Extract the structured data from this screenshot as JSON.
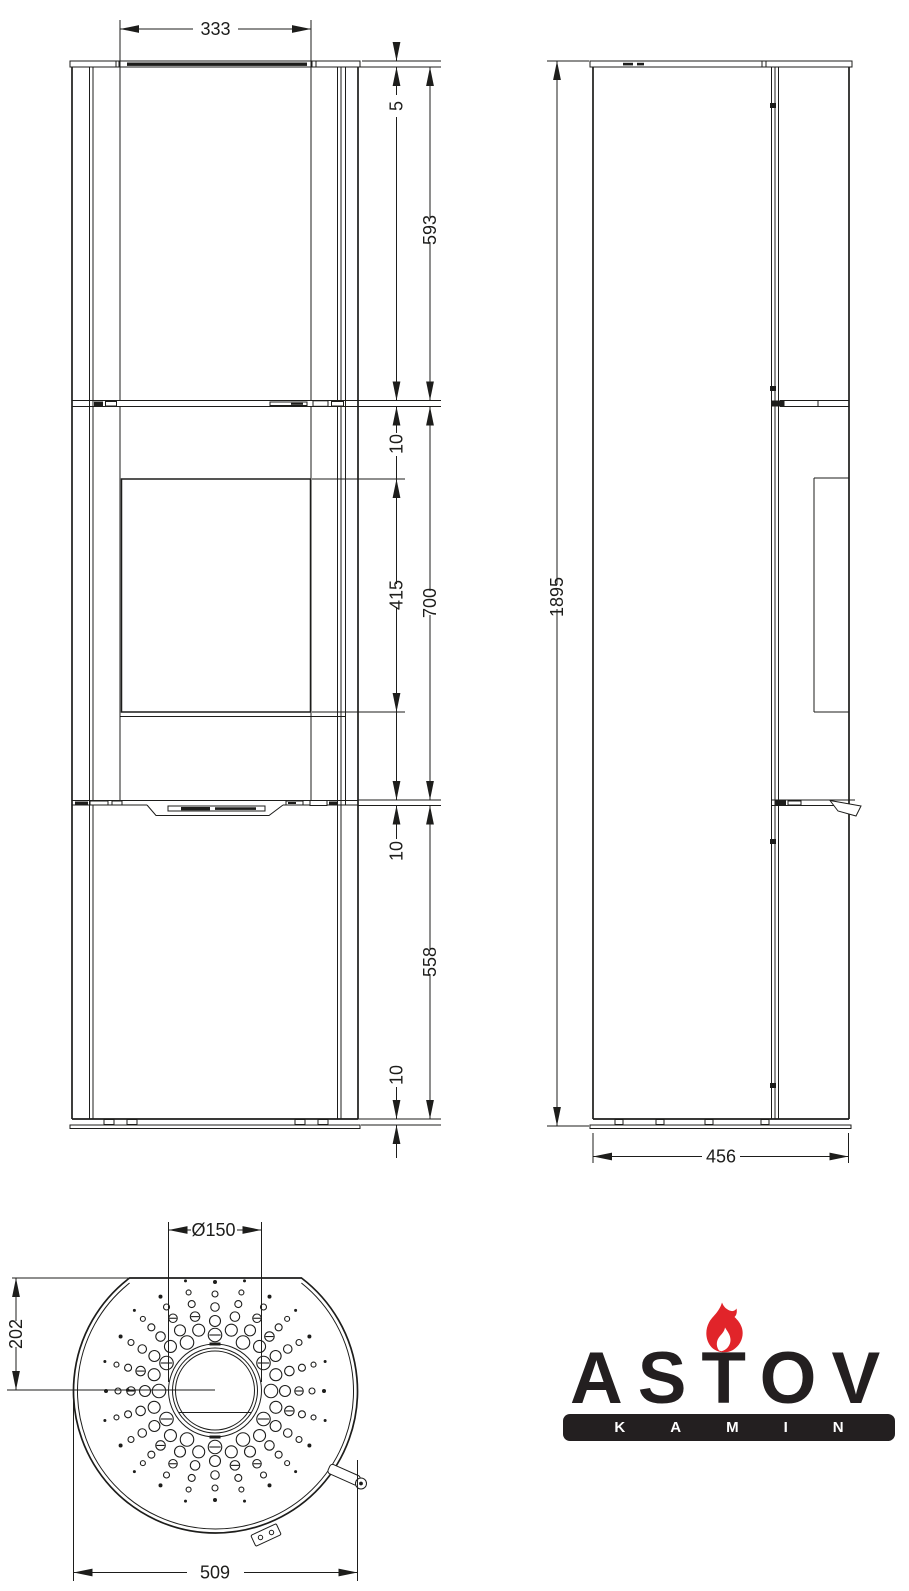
{
  "drawing": {
    "line_color": "#1d1d1b",
    "dims": {
      "front_door_width": "333",
      "front_plate": "5",
      "front_upper": "593",
      "front_gap_top": "10",
      "front_glass": "415",
      "front_middle": "700",
      "front_gap_mid": "10",
      "front_lower": "558",
      "front_base": "10",
      "side_height": "1895",
      "side_depth": "456",
      "top_flue": "Ø150",
      "top_flue_offset": "202",
      "top_width": "509"
    }
  },
  "logo": {
    "brand": "ASTOV",
    "subtitle": "KAMIN",
    "flame_color": "#e1242a",
    "text_color": "#231f20"
  },
  "perforation": {
    "cx": 215,
    "cy": 1391,
    "spokes": 24,
    "color": "#1d1d1b",
    "rings_even": [
      [
        56,
        13.5
      ],
      [
        70,
        11
      ],
      [
        84,
        8.5
      ],
      [
        97,
        6
      ],
      [
        109,
        4
      ]
    ],
    "rings_odd": [
      [
        63,
        12
      ],
      [
        77,
        9.5
      ],
      [
        90,
        7
      ],
      [
        102,
        5
      ],
      [
        114,
        3
      ]
    ]
  }
}
